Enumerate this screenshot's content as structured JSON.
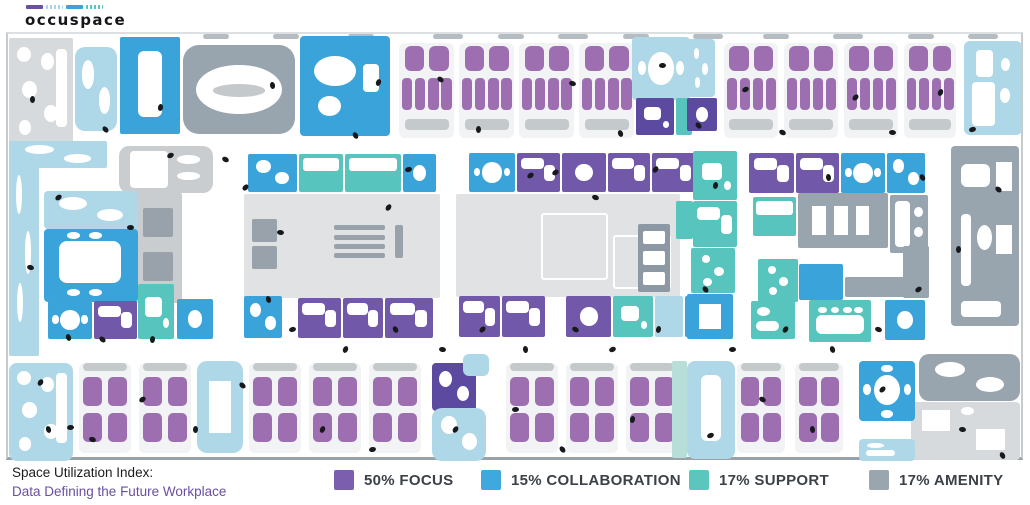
{
  "logo": {
    "text": "occuspace",
    "bars": [
      {
        "name": "focus-bar",
        "color": "#6b4fa0",
        "dotted": false
      },
      {
        "name": "lounge-bar",
        "color": "#a9d4e8",
        "dotted": true
      },
      {
        "name": "collaboration-bar",
        "color": "#3aa4da",
        "dotted": false
      },
      {
        "name": "support-bar",
        "color": "#57c5bd",
        "dotted": true
      }
    ]
  },
  "footer": {
    "title": "Space Utilization Index:",
    "subtitle": "Data Defining the Future Workplace",
    "subtitle_color": "#6a4fa1"
  },
  "legend": [
    {
      "label": "50% FOCUS",
      "percent": 50,
      "category": "focus",
      "color": "#7b5fae"
    },
    {
      "label": "15% COLLABORATION",
      "percent": 15,
      "category": "collaboration",
      "color": "#3fa8dc"
    },
    {
      "label": "17% SUPPORT",
      "percent": 17,
      "category": "support",
      "color": "#5bc6be"
    },
    {
      "label": "17% AMENITY",
      "percent": 17,
      "category": "amenity",
      "color": "#9aa5af"
    }
  ],
  "palette": {
    "focus": "#7258a9",
    "focus_dark": "#5b4a9f",
    "pod": "#9d6fb1",
    "podbg": "#f2f3f4",
    "collab": "#3aa4da",
    "support": "#57c5bd",
    "amenity": "#98a4ae",
    "amenity_dark": "#8c98a3",
    "lounge": "#aed7e8",
    "mint": "#b7ded9",
    "open": "#e0e2e3",
    "palegray": "#d6dadc",
    "core": "#c9cdd0",
    "wall": "#b6bdc2",
    "people": "#17191c"
  },
  "floorplan": {
    "rooms": [
      [
        "wall",
        195,
        0,
        26,
        5
      ],
      [
        "wall",
        265,
        0,
        26,
        5
      ],
      [
        "wall",
        340,
        0,
        26,
        5
      ],
      [
        "wall",
        425,
        0,
        30,
        5
      ],
      [
        "wall",
        490,
        0,
        26,
        5
      ],
      [
        "wall",
        550,
        0,
        30,
        5
      ],
      [
        "wall",
        615,
        0,
        26,
        5
      ],
      [
        "wall",
        685,
        0,
        30,
        5
      ],
      [
        "wall",
        755,
        0,
        26,
        5
      ],
      [
        "wall",
        825,
        0,
        30,
        5
      ],
      [
        "wall",
        900,
        0,
        26,
        5
      ],
      [
        "wall",
        960,
        0,
        30,
        5
      ],
      [
        "palegray",
        1,
        4,
        64,
        108,
        "blobs-many",
        2
      ],
      [
        "lounge",
        67,
        13,
        42,
        84,
        "blobs2",
        10
      ],
      [
        "collab",
        112,
        3,
        60,
        97,
        "table-v",
        2
      ],
      [
        "amenity",
        175,
        11,
        112,
        89,
        "oval-ring",
        16
      ],
      [
        "collab",
        292,
        2,
        90,
        100,
        "lounge-mix",
        4
      ],
      [
        "pods",
        391,
        9,
        55,
        95,
        "pods-h",
        6
      ],
      [
        "pods",
        451,
        9,
        55,
        95,
        "pods-h",
        6
      ],
      [
        "pods",
        511,
        9,
        55,
        95,
        "pods-h",
        6
      ],
      [
        "pods",
        571,
        9,
        55,
        95,
        "pods-h",
        6
      ],
      [
        "lounge",
        624,
        3,
        58,
        63,
        "round-table",
        4
      ],
      [
        "focus_dark",
        628,
        64,
        38,
        37,
        "mini",
        2
      ],
      [
        "support",
        668,
        64,
        16,
        37,
        "",
        2
      ],
      [
        "lounge",
        679,
        5,
        28,
        58,
        "dots-white",
        4
      ],
      [
        "focus_dark",
        679,
        64,
        30,
        33,
        "blob1",
        2
      ],
      [
        "pods",
        716,
        9,
        54,
        95,
        "pods-h",
        6
      ],
      [
        "pods",
        776,
        9,
        54,
        95,
        "pods-h",
        6
      ],
      [
        "pods",
        836,
        9,
        54,
        95,
        "pods-h",
        6
      ],
      [
        "pods",
        896,
        9,
        52,
        95,
        "pods-h",
        6
      ],
      [
        "lounge",
        956,
        7,
        58,
        94,
        "kitchen",
        6
      ],
      [
        "lounge",
        1,
        107,
        30,
        215,
        "dots-white",
        2
      ],
      [
        "lounge",
        1,
        107,
        98,
        27,
        "blobs2",
        2
      ],
      [
        "core",
        111,
        112,
        94,
        47,
        "counter",
        10
      ],
      [
        "core",
        126,
        159,
        48,
        110,
        "elevator",
        2
      ],
      [
        "lounge",
        36,
        157,
        94,
        38,
        "blobs2",
        4
      ],
      [
        "collab",
        36,
        195,
        94,
        73,
        "conf-large",
        4
      ],
      [
        "collab",
        40,
        267,
        44,
        38,
        "round-table",
        2
      ],
      [
        "focus",
        86,
        267,
        43,
        38,
        "desk",
        2
      ],
      [
        "support",
        130,
        250,
        36,
        55,
        "mini",
        2
      ],
      [
        "collab",
        169,
        265,
        36,
        40,
        "blob1",
        2
      ],
      [
        "collab",
        240,
        120,
        49,
        38,
        "blobs2",
        2
      ],
      [
        "support",
        291,
        120,
        44,
        38,
        "panel",
        2
      ],
      [
        "support",
        337,
        120,
        56,
        38,
        "panel",
        2
      ],
      [
        "collab",
        395,
        120,
        33,
        38,
        "blob1",
        2
      ],
      [
        "open",
        236,
        160,
        196,
        104,
        "stairs",
        2
      ],
      [
        "collab",
        236,
        262,
        38,
        42,
        "blobs2",
        2
      ],
      [
        "focus",
        290,
        264,
        43,
        40,
        "desk",
        2
      ],
      [
        "focus",
        335,
        264,
        40,
        40,
        "desk",
        2
      ],
      [
        "focus",
        377,
        264,
        48,
        40,
        "desk",
        2
      ],
      [
        "collab",
        461,
        119,
        46,
        39,
        "round-table",
        2
      ],
      [
        "focus",
        509,
        119,
        43,
        39,
        "desk",
        2
      ],
      [
        "focus",
        554,
        119,
        44,
        39,
        "blob1",
        2
      ],
      [
        "focus",
        600,
        119,
        42,
        39,
        "desk",
        2
      ],
      [
        "focus",
        644,
        119,
        44,
        39,
        "desk",
        2
      ],
      [
        "open",
        448,
        160,
        224,
        103,
        "rooms-faint",
        2
      ],
      [
        "amenity_dark",
        630,
        190,
        32,
        68,
        "stalls",
        2
      ],
      [
        "support",
        668,
        167,
        17,
        38,
        "",
        2
      ],
      [
        "focus",
        451,
        262,
        41,
        41,
        "desk",
        2
      ],
      [
        "focus",
        494,
        262,
        43,
        41,
        "desk",
        2
      ],
      [
        "focus",
        558,
        262,
        45,
        41,
        "blob1",
        2
      ],
      [
        "support",
        605,
        262,
        40,
        41,
        "mini",
        2
      ],
      [
        "lounge",
        647,
        262,
        28,
        41,
        "",
        2
      ],
      [
        "collab",
        677,
        262,
        12,
        41,
        "",
        2
      ],
      [
        "support",
        685,
        117,
        44,
        49,
        "mini",
        2
      ],
      [
        "support",
        685,
        167,
        44,
        46,
        "desk",
        2
      ],
      [
        "support",
        683,
        214,
        44,
        45,
        "dots-white",
        2
      ],
      [
        "collab",
        679,
        260,
        46,
        45,
        "x-table",
        2
      ],
      [
        "focus",
        741,
        119,
        45,
        40,
        "desk",
        2
      ],
      [
        "focus",
        788,
        119,
        43,
        40,
        "desk",
        2
      ],
      [
        "collab",
        833,
        119,
        44,
        40,
        "round-table",
        2
      ],
      [
        "collab",
        879,
        119,
        38,
        40,
        "blobs2",
        2
      ],
      [
        "support",
        745,
        163,
        43,
        39,
        "panel",
        2
      ],
      [
        "amenity",
        790,
        159,
        90,
        55,
        "diag-tables",
        2
      ],
      [
        "amenity",
        882,
        161,
        38,
        58,
        "counter",
        2
      ],
      [
        "support",
        750,
        225,
        40,
        43,
        "dots-white",
        2
      ],
      [
        "collab",
        791,
        230,
        44,
        36,
        "",
        2
      ],
      [
        "amenity",
        837,
        243,
        84,
        20,
        "",
        2
      ],
      [
        "amenity",
        895,
        212,
        26,
        52,
        "",
        2
      ],
      [
        "support",
        743,
        267,
        44,
        38,
        "bench",
        2
      ],
      [
        "support",
        801,
        266,
        62,
        42,
        "scallop",
        2
      ],
      [
        "collab",
        877,
        266,
        40,
        40,
        "blob1",
        2
      ],
      [
        "amenity",
        943,
        112,
        68,
        180,
        "cafe-tables",
        4
      ],
      [
        "amenity",
        911,
        320,
        101,
        47,
        "blobs2",
        10
      ],
      [
        "palegray",
        903,
        368,
        109,
        58,
        "x2",
        4
      ],
      [
        "lounge",
        1,
        329,
        64,
        98,
        "blobs-many",
        8
      ],
      [
        "pods",
        71,
        329,
        52,
        90,
        "pods-v",
        6
      ],
      [
        "pods",
        131,
        329,
        52,
        90,
        "pods-v",
        6
      ],
      [
        "lounge",
        189,
        327,
        46,
        92,
        "x-table",
        10
      ],
      [
        "pods",
        241,
        329,
        52,
        90,
        "pods-v",
        6
      ],
      [
        "pods",
        301,
        329,
        52,
        90,
        "pods-v",
        6
      ],
      [
        "pods",
        361,
        329,
        52,
        90,
        "pods-v",
        6
      ],
      [
        "focus_dark",
        424,
        329,
        44,
        48,
        "blobs2",
        4
      ],
      [
        "lounge",
        455,
        320,
        26,
        22,
        "",
        6
      ],
      [
        "lounge",
        424,
        374,
        54,
        53,
        "blobs2",
        10
      ],
      [
        "pods",
        498,
        329,
        52,
        90,
        "pods-v",
        6
      ],
      [
        "pods",
        558,
        329,
        52,
        90,
        "pods-v",
        6
      ],
      [
        "pods",
        618,
        329,
        52,
        90,
        "pods-v",
        6
      ],
      [
        "mint",
        664,
        327,
        15,
        97,
        "",
        2
      ],
      [
        "lounge",
        679,
        327,
        48,
        98,
        "table-v",
        8
      ],
      [
        "pods",
        729,
        329,
        48,
        90,
        "pods-v",
        6
      ],
      [
        "pods",
        787,
        329,
        48,
        90,
        "pods-v",
        6
      ],
      [
        "collab",
        851,
        327,
        56,
        60,
        "round-chairs",
        4
      ],
      [
        "lounge",
        851,
        405,
        56,
        22,
        "bench",
        4
      ]
    ],
    "people_dots": [
      [
        22,
        62
      ],
      [
        48,
        160
      ],
      [
        20,
        230
      ],
      [
        58,
        300
      ],
      [
        30,
        345
      ],
      [
        60,
        390
      ],
      [
        95,
        92
      ],
      [
        150,
        70
      ],
      [
        160,
        118
      ],
      [
        215,
        122
      ],
      [
        262,
        48
      ],
      [
        235,
        150
      ],
      [
        270,
        195
      ],
      [
        345,
        98
      ],
      [
        368,
        45
      ],
      [
        398,
        132
      ],
      [
        430,
        42
      ],
      [
        468,
        92
      ],
      [
        520,
        138
      ],
      [
        562,
        46
      ],
      [
        610,
        96
      ],
      [
        645,
        132
      ],
      [
        652,
        28
      ],
      [
        688,
        88
      ],
      [
        705,
        148
      ],
      [
        735,
        52
      ],
      [
        772,
        95
      ],
      [
        818,
        140
      ],
      [
        845,
        60
      ],
      [
        882,
        95
      ],
      [
        912,
        140
      ],
      [
        930,
        55
      ],
      [
        962,
        92
      ],
      [
        988,
        152
      ],
      [
        948,
        212
      ],
      [
        908,
        252
      ],
      [
        868,
        292
      ],
      [
        822,
        312
      ],
      [
        775,
        292
      ],
      [
        722,
        312
      ],
      [
        695,
        252
      ],
      [
        648,
        292
      ],
      [
        602,
        312
      ],
      [
        565,
        292
      ],
      [
        515,
        312
      ],
      [
        472,
        292
      ],
      [
        432,
        312
      ],
      [
        385,
        292
      ],
      [
        335,
        312
      ],
      [
        282,
        292
      ],
      [
        232,
        348
      ],
      [
        185,
        392
      ],
      [
        132,
        362
      ],
      [
        82,
        402
      ],
      [
        38,
        392
      ],
      [
        445,
        392
      ],
      [
        505,
        372
      ],
      [
        552,
        412
      ],
      [
        622,
        382
      ],
      [
        700,
        398
      ],
      [
        752,
        362
      ],
      [
        802,
        392
      ],
      [
        872,
        352
      ],
      [
        952,
        392
      ],
      [
        992,
        418
      ],
      [
        312,
        392
      ],
      [
        362,
        412
      ],
      [
        92,
        302
      ],
      [
        142,
        302
      ],
      [
        545,
        135
      ],
      [
        585,
        160
      ],
      [
        258,
        262
      ],
      [
        378,
        170
      ],
      [
        120,
        190
      ]
    ]
  }
}
